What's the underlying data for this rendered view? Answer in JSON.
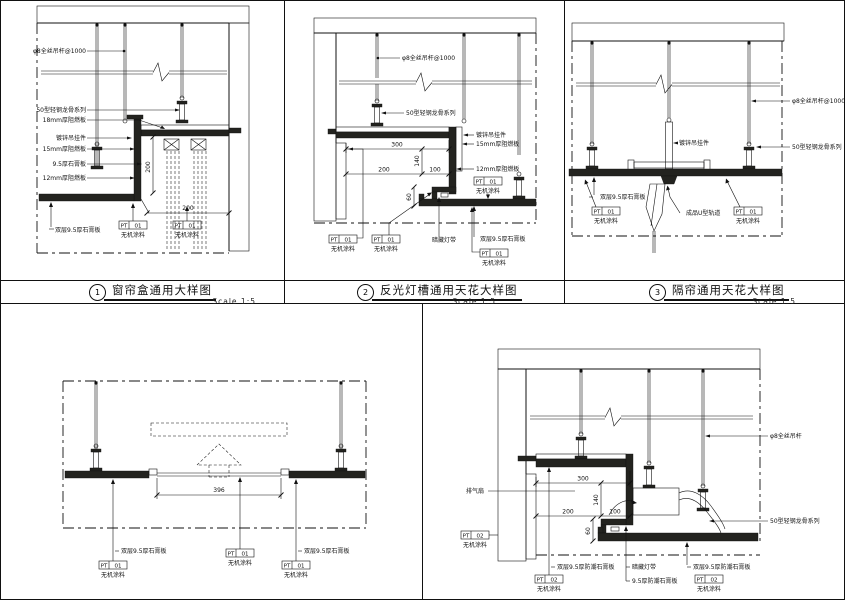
{
  "sheet": {
    "background": "#ffffff",
    "line_color": "#111111"
  },
  "titles": [
    {
      "num": "1",
      "label": "窗帘盒通用大样图",
      "scale": "Scale  1:5"
    },
    {
      "num": "2",
      "label": "反光灯槽通用天花大样图",
      "scale": "Scale  1:5"
    },
    {
      "num": "3",
      "label": "隔帘通用天花大样图",
      "scale": "Scale  1:5"
    }
  ],
  "tags": {
    "pt01": {
      "code": "PT",
      "num": "01",
      "label": "无机涂料"
    },
    "pt02": {
      "code": "PT",
      "num": "02",
      "label": "无机涂料"
    }
  },
  "d1": {
    "rod": "φ8全丝吊杆@1000",
    "keel": "50型轻钢龙骨系列",
    "board18": "18mm厚阻燃板",
    "hanger": "镀锌吊挂件",
    "board15": "15mm厚阻燃板",
    "gyp": "9.5厚石膏板",
    "board12": "12mm厚阻燃板",
    "dgyp": "双层9.5厚石膏板",
    "dim_v": "200",
    "dim_h": "200"
  },
  "d2": {
    "rod": "φ8全丝吊杆@1000",
    "keel": "50型轻钢龙骨系列",
    "hanger": "镀锌吊挂件",
    "board15": "15mm厚阻燃板",
    "board12": "12mm厚阻燃板",
    "light": "暗藏灯带",
    "dgyp": "双层9.5厚石膏板",
    "dim_300": "300",
    "dim_140": "140",
    "dim_200": "200",
    "dim_100": "100",
    "dim_60": "60"
  },
  "d3": {
    "rod": "φ8全丝吊杆@1000",
    "keel": "50型轻钢龙骨系列",
    "hanger": "镀锌吊挂件",
    "dgyp": "双层9.5厚石膏板",
    "track": "成品U型轨道"
  },
  "d4": {
    "dgyp_left": "双层9.5厚石膏板",
    "dgyp_right": "双层9.5厚石膏板",
    "dim": "396"
  },
  "d5": {
    "rod": "φ8全丝吊杆",
    "keel": "50型轻钢龙骨系列",
    "fan": "排气扇",
    "dgyp_left": "双层9.5厚防潮石膏板",
    "light": "暗藏灯带",
    "gyp": "9.5厚防潮石膏板",
    "dgyp_right": "双层9.5厚防潮石膏板",
    "dim_300": "300",
    "dim_140": "140",
    "dim_200": "200",
    "dim_100": "100",
    "dim_60": "60"
  }
}
